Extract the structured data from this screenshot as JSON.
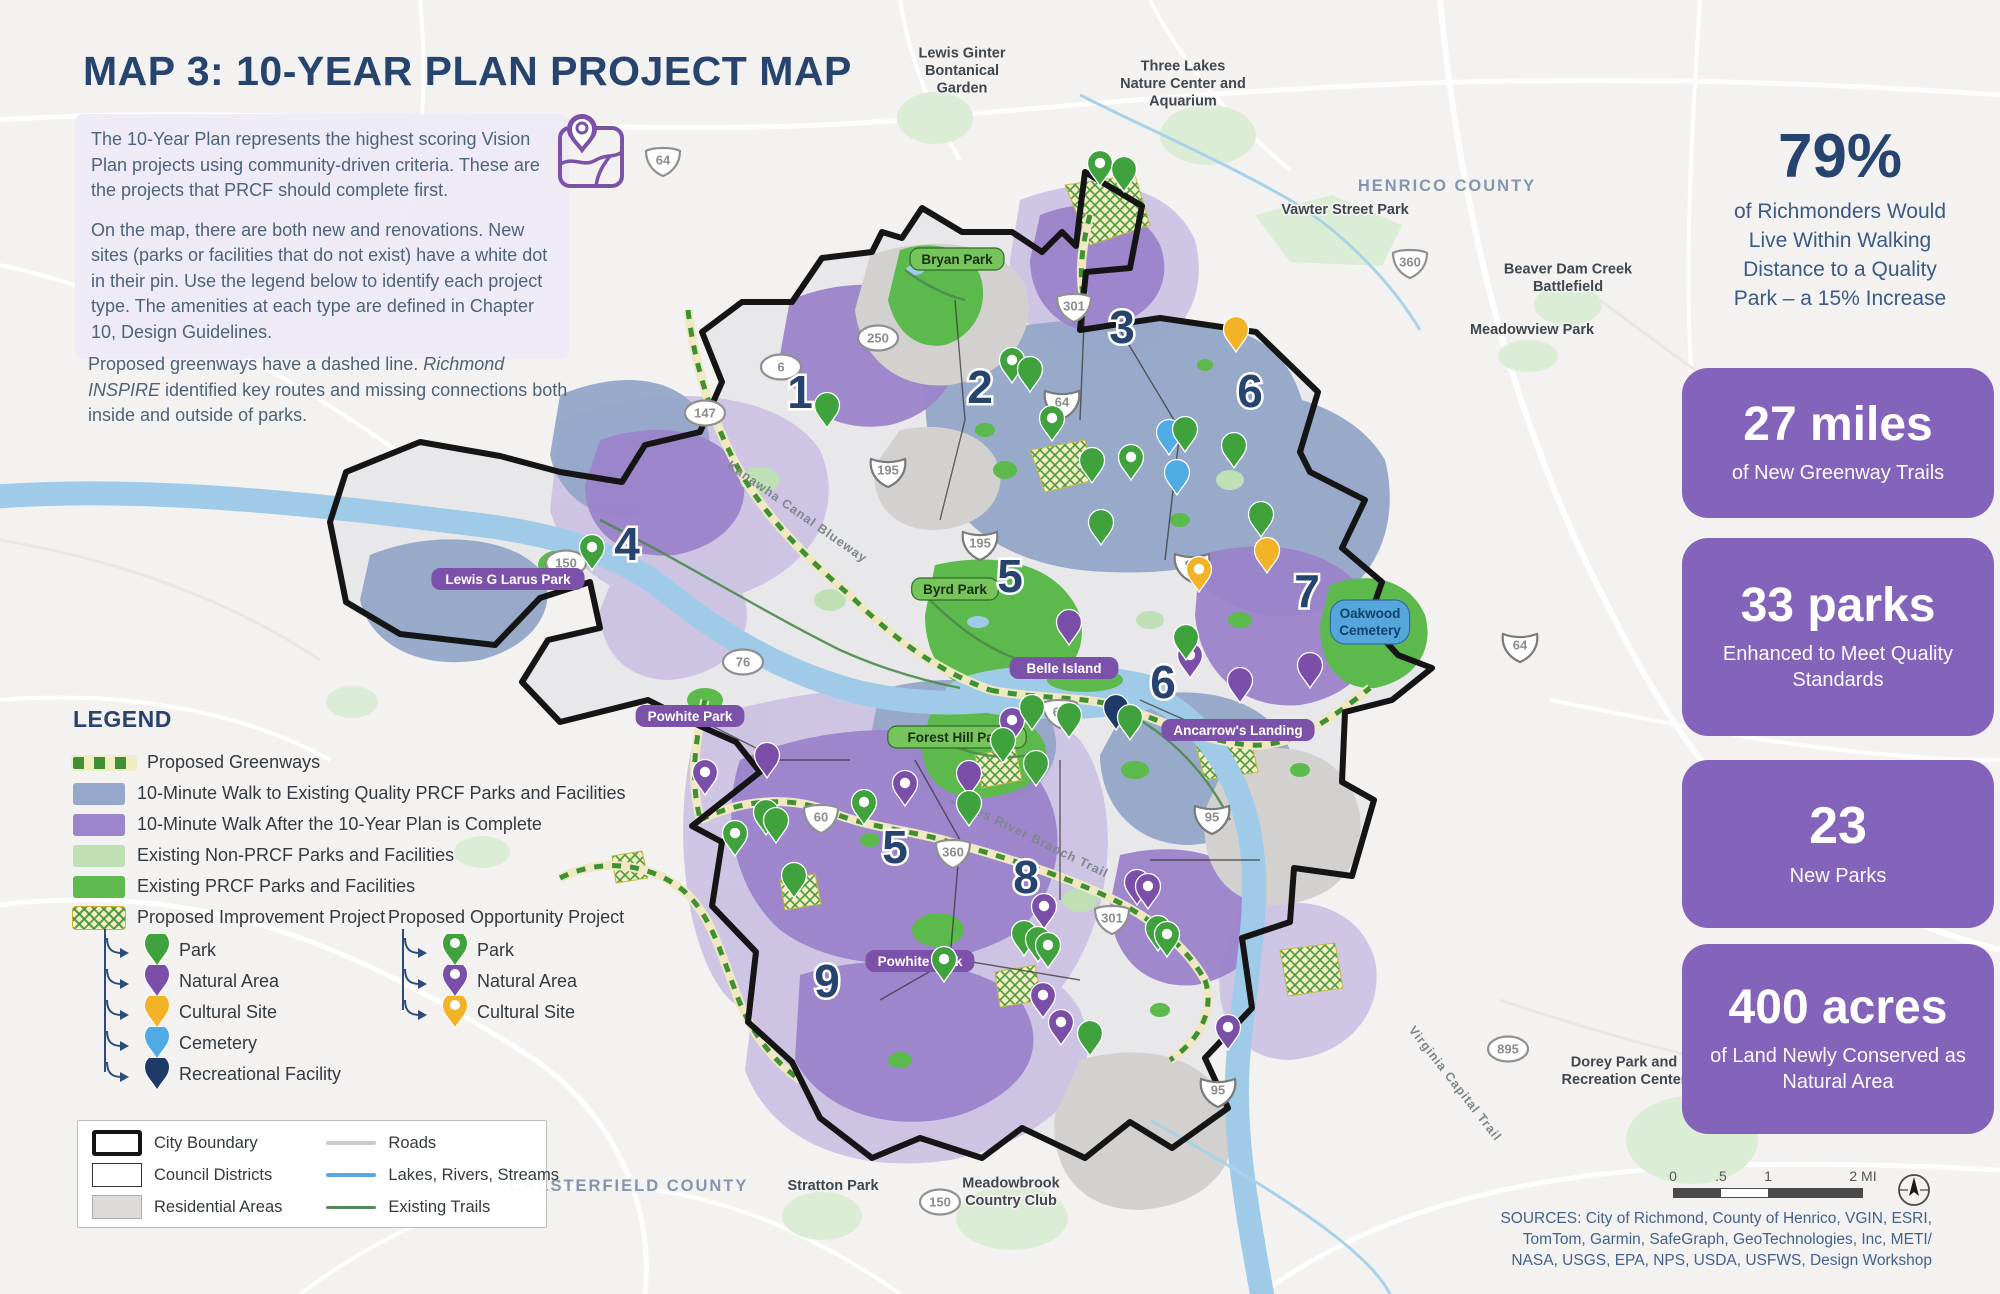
{
  "title": {
    "text": "MAP 3: 10-YEAR PLAN PROJECT MAP"
  },
  "intro": {
    "p1": " The 10-Year Plan represents the highest scoring Vision Plan projects using community-driven criteria. These are the projects that PRCF should complete first.",
    "p2": "On the map, there are both new and renovations. New sites (parks or facilities that do not exist) have a white dot in their pin. Use the legend below to identify each project type. The amenities at each type are defined in Chapter 10, Design Guidelines.",
    "p3a": "Proposed greenways have a dashed line. ",
    "p3b": "Richmond INSPIRE",
    "p3c": " identified key routes and missing connections both inside and outside of parks."
  },
  "stats": {
    "headline": {
      "value": "79%",
      "caption": "of Richmonders Would Live Within Walking Distance to a Quality Park – a 15% Increase"
    },
    "boxes": [
      {
        "value": "27 miles",
        "caption": "of New Greenway Trails"
      },
      {
        "value": "33 parks",
        "caption": "Enhanced to Meet Quality Standards"
      },
      {
        "value": "23",
        "caption": "New Parks"
      },
      {
        "value": "400 acres",
        "caption": "of Land Newly Conserved as Natural Area"
      }
    ]
  },
  "legend": {
    "heading": "LEGEND",
    "area_items": [
      {
        "swatch": "greenway-dash",
        "label": "Proposed Greenways"
      },
      {
        "swatch": "blue-gray",
        "label": "10-Minute Walk to Existing Quality PRCF Parks and Facilities"
      },
      {
        "swatch": "purple",
        "label": "10-Minute Walk After the 10-Year Plan is Complete"
      },
      {
        "swatch": "light-green",
        "label": "Existing Non-PRCF Parks and Facilities"
      },
      {
        "swatch": "green",
        "label": "Existing PRCF Parks and Facilities"
      }
    ],
    "improvement": {
      "title": "Proposed Improvement Project",
      "items": [
        {
          "pin": "green",
          "dot": false,
          "label": "Park"
        },
        {
          "pin": "purple",
          "dot": false,
          "label": "Natural Area"
        },
        {
          "pin": "yellow",
          "dot": false,
          "label": "Cultural Site"
        },
        {
          "pin": "blue",
          "dot": false,
          "label": "Cemetery"
        },
        {
          "pin": "navy",
          "dot": false,
          "label": "Recreational Facility"
        }
      ]
    },
    "opportunity": {
      "title": "Proposed Opportunity Project",
      "items": [
        {
          "pin": "green",
          "dot": true,
          "label": "Park"
        },
        {
          "pin": "purple",
          "dot": true,
          "label": "Natural Area"
        },
        {
          "pin": "yellow",
          "dot": true,
          "label": "Cultural Site"
        }
      ]
    },
    "base_items_col1": [
      {
        "swatch": "city-boundary",
        "label": "City Boundary"
      },
      {
        "swatch": "council-districts",
        "label": "Council Districts"
      },
      {
        "swatch": "residential",
        "label": "Residential Areas"
      }
    ],
    "base_items_col2": [
      {
        "swatch": "road-line",
        "label": "Roads"
      },
      {
        "swatch": "water-line",
        "label": "Lakes, Rivers, Streams"
      },
      {
        "swatch": "trail-line",
        "label": "Existing Trails"
      }
    ]
  },
  "map": {
    "county_labels": [
      {
        "text": "HENRICO COUNTY",
        "x": 1447,
        "y": 191
      },
      {
        "text": "CHESTERFIELD COUNTY",
        "x": 629,
        "y": 1191
      }
    ],
    "place_labels": [
      {
        "text": "Lewis Ginter\nBontanical\nGarden",
        "x": 962,
        "y": 75
      },
      {
        "text": "Three Lakes\nNature Center and\nAquarium",
        "x": 1183,
        "y": 88
      },
      {
        "text": "Vawter Street Park",
        "x": 1345,
        "y": 214
      },
      {
        "text": "Beaver Dam Creek\nBattlefield",
        "x": 1568,
        "y": 282
      },
      {
        "text": "Meadowview Park",
        "x": 1532,
        "y": 334
      },
      {
        "text": "Stratton Park",
        "x": 833,
        "y": 1190
      },
      {
        "text": "Meadowbrook\nCountry Club",
        "x": 1011,
        "y": 1196
      },
      {
        "text": "Dorey Park and\nRecreation Center",
        "x": 1624,
        "y": 1075
      }
    ],
    "park_pills": [
      {
        "text": "Bryan Park",
        "style": "green",
        "x": 957,
        "y": 259
      },
      {
        "text": "Byrd Park",
        "style": "green",
        "x": 955,
        "y": 589
      },
      {
        "text": "Forest Hill Park",
        "style": "green",
        "x": 957,
        "y": 737
      },
      {
        "text": "Belle Island",
        "style": "purple",
        "x": 1064,
        "y": 668
      },
      {
        "text": "Lewis G Larus Park",
        "style": "purple",
        "x": 508,
        "y": 579
      },
      {
        "text": "Powhite Park",
        "style": "purple",
        "x": 690,
        "y": 716
      },
      {
        "text": "Powhite Park",
        "style": "purple",
        "x": 920,
        "y": 961
      },
      {
        "text": "Ancarrow's Landing",
        "style": "purple",
        "x": 1238,
        "y": 730
      },
      {
        "text": "Oakwood\nCemetery",
        "style": "blue",
        "x": 1370,
        "y": 622
      }
    ],
    "trail_labels": [
      {
        "text": "Virginia Capital Trail",
        "x": 1452,
        "y": 1086,
        "rot": 52
      },
      {
        "text": "James River Branch Trail",
        "x": 1028,
        "y": 840,
        "rot": 26
      },
      {
        "text": "Kanawha Canal Blueway",
        "x": 795,
        "y": 515,
        "rot": 35
      }
    ],
    "shields": [
      {
        "num": "64",
        "type": "shield",
        "x": 663,
        "y": 160
      },
      {
        "num": "250",
        "type": "oval",
        "x": 878,
        "y": 338
      },
      {
        "num": "301",
        "type": "shield",
        "x": 1074,
        "y": 306
      },
      {
        "num": "360",
        "type": "shield",
        "x": 1410,
        "y": 262
      },
      {
        "num": "64",
        "type": "interstate",
        "x": 1062,
        "y": 402
      },
      {
        "num": "6",
        "type": "oval",
        "x": 781,
        "y": 367
      },
      {
        "num": "147",
        "type": "oval",
        "x": 705,
        "y": 413
      },
      {
        "num": "195",
        "type": "interstate",
        "x": 888,
        "y": 470
      },
      {
        "num": "195",
        "type": "interstate",
        "x": 980,
        "y": 543
      },
      {
        "num": "150",
        "type": "oval",
        "x": 566,
        "y": 563
      },
      {
        "num": "76",
        "type": "oval",
        "x": 743,
        "y": 662
      },
      {
        "num": "95",
        "type": "interstate",
        "x": 1192,
        "y": 565
      },
      {
        "num": "64",
        "type": "interstate",
        "x": 1520,
        "y": 645
      },
      {
        "num": "60",
        "type": "shield",
        "x": 1060,
        "y": 712
      },
      {
        "num": "60",
        "type": "shield",
        "x": 821,
        "y": 817
      },
      {
        "num": "360",
        "type": "shield",
        "x": 953,
        "y": 852
      },
      {
        "num": "95",
        "type": "interstate",
        "x": 1212,
        "y": 817
      },
      {
        "num": "301",
        "type": "shield",
        "x": 1112,
        "y": 918
      },
      {
        "num": "95",
        "type": "interstate",
        "x": 1218,
        "y": 1090
      },
      {
        "num": "150",
        "type": "oval",
        "x": 940,
        "y": 1202
      },
      {
        "num": "895",
        "type": "oval",
        "x": 1508,
        "y": 1049
      }
    ],
    "districts": [
      {
        "n": "1",
        "x": 800,
        "y": 408
      },
      {
        "n": "2",
        "x": 980,
        "y": 403
      },
      {
        "n": "3",
        "x": 1122,
        "y": 343
      },
      {
        "n": "4",
        "x": 627,
        "y": 560
      },
      {
        "n": "5",
        "x": 1010,
        "y": 592
      },
      {
        "n": "5",
        "x": 895,
        "y": 863
      },
      {
        "n": "6",
        "x": 1250,
        "y": 407
      },
      {
        "n": "6",
        "x": 1163,
        "y": 698
      },
      {
        "n": "7",
        "x": 1307,
        "y": 607
      },
      {
        "n": "8",
        "x": 1026,
        "y": 893
      },
      {
        "n": "9",
        "x": 827,
        "y": 997
      }
    ],
    "pins": [
      {
        "c": "green",
        "dot": true,
        "x": 1100,
        "y": 186
      },
      {
        "c": "green",
        "dot": false,
        "x": 1124,
        "y": 192
      },
      {
        "c": "yellow",
        "dot": false,
        "x": 1236,
        "y": 352
      },
      {
        "c": "green",
        "dot": true,
        "x": 1012,
        "y": 383
      },
      {
        "c": "green",
        "dot": false,
        "x": 1030,
        "y": 392
      },
      {
        "c": "green",
        "dot": true,
        "x": 1052,
        "y": 441
      },
      {
        "c": "green",
        "dot": false,
        "x": 1092,
        "y": 483
      },
      {
        "c": "green",
        "dot": true,
        "x": 1131,
        "y": 480
      },
      {
        "c": "blue",
        "dot": false,
        "x": 1169,
        "y": 455
      },
      {
        "c": "blue",
        "dot": false,
        "x": 1177,
        "y": 495
      },
      {
        "c": "green",
        "dot": false,
        "x": 1185,
        "y": 452
      },
      {
        "c": "green",
        "dot": false,
        "x": 1234,
        "y": 468
      },
      {
        "c": "green",
        "dot": false,
        "x": 827,
        "y": 428
      },
      {
        "c": "green",
        "dot": true,
        "x": 592,
        "y": 570
      },
      {
        "c": "green",
        "dot": false,
        "x": 1101,
        "y": 545
      },
      {
        "c": "green",
        "dot": false,
        "x": 1261,
        "y": 537
      },
      {
        "c": "yellow",
        "dot": false,
        "x": 1267,
        "y": 573
      },
      {
        "c": "yellow",
        "dot": true,
        "x": 1199,
        "y": 592
      },
      {
        "c": "purple",
        "dot": false,
        "x": 1310,
        "y": 688
      },
      {
        "c": "purple",
        "dot": false,
        "x": 1240,
        "y": 703
      },
      {
        "c": "purple",
        "dot": true,
        "x": 1190,
        "y": 678
      },
      {
        "c": "green",
        "dot": false,
        "x": 1186,
        "y": 660
      },
      {
        "c": "purple",
        "dot": false,
        "x": 1069,
        "y": 645
      },
      {
        "c": "purple",
        "dot": true,
        "x": 1012,
        "y": 743
      },
      {
        "c": "green",
        "dot": false,
        "x": 1032,
        "y": 730
      },
      {
        "c": "green",
        "dot": false,
        "x": 1003,
        "y": 763
      },
      {
        "c": "green",
        "dot": false,
        "x": 1069,
        "y": 738
      },
      {
        "c": "green",
        "dot": false,
        "x": 1036,
        "y": 786
      },
      {
        "c": "navy",
        "dot": false,
        "x": 1116,
        "y": 730
      },
      {
        "c": "green",
        "dot": false,
        "x": 1130,
        "y": 740
      },
      {
        "c": "purple",
        "dot": false,
        "x": 969,
        "y": 796
      },
      {
        "c": "green",
        "dot": false,
        "x": 969,
        "y": 826
      },
      {
        "c": "purple",
        "dot": true,
        "x": 705,
        "y": 795
      },
      {
        "c": "purple",
        "dot": false,
        "x": 767,
        "y": 778
      },
      {
        "c": "green",
        "dot": true,
        "x": 864,
        "y": 825
      },
      {
        "c": "purple",
        "dot": true,
        "x": 905,
        "y": 806
      },
      {
        "c": "green",
        "dot": false,
        "x": 766,
        "y": 835
      },
      {
        "c": "green",
        "dot": false,
        "x": 776,
        "y": 843
      },
      {
        "c": "green",
        "dot": true,
        "x": 735,
        "y": 856
      },
      {
        "c": "green",
        "dot": false,
        "x": 794,
        "y": 898
      },
      {
        "c": "green",
        "dot": true,
        "x": 944,
        "y": 982
      },
      {
        "c": "purple",
        "dot": true,
        "x": 1044,
        "y": 929
      },
      {
        "c": "green",
        "dot": false,
        "x": 1024,
        "y": 956
      },
      {
        "c": "green",
        "dot": false,
        "x": 1038,
        "y": 962
      },
      {
        "c": "green",
        "dot": true,
        "x": 1048,
        "y": 968
      },
      {
        "c": "purple",
        "dot": false,
        "x": 1137,
        "y": 905
      },
      {
        "c": "purple",
        "dot": true,
        "x": 1148,
        "y": 909
      },
      {
        "c": "green",
        "dot": false,
        "x": 1158,
        "y": 951
      },
      {
        "c": "green",
        "dot": true,
        "x": 1167,
        "y": 957
      },
      {
        "c": "purple",
        "dot": true,
        "x": 1043,
        "y": 1018
      },
      {
        "c": "purple",
        "dot": true,
        "x": 1061,
        "y": 1045
      },
      {
        "c": "green",
        "dot": false,
        "x": 1090,
        "y": 1056
      },
      {
        "c": "purple",
        "dot": true,
        "x": 1228,
        "y": 1050
      }
    ]
  },
  "scalebar": {
    "labels": [
      "0",
      ".5",
      "1",
      "2 MI"
    ]
  },
  "sources": {
    "line1": "SOURCES: City of Richmond, County of Henrico, VGIN, ESRI,",
    "line2": "TomTom, Garmin, SafeGraph, GeoTechnologies, Inc, METI/",
    "line3": "NASA, USGS, EPA, NPS, USDA, USFWS, Design Workshop"
  },
  "colors": {
    "navy_title": "#27446E",
    "body_text": "#4E6377",
    "stat_purple": "#8464BB",
    "walk_existing": "#96A8C9",
    "walk_after": "#9C85CB",
    "non_prcf_green": "#BEE0B4",
    "prcf_green": "#5FBA4F",
    "water": "#9FCBE8",
    "pin": {
      "green": "#3FA23C",
      "purple": "#7B4FA9",
      "yellow": "#F2B327",
      "blue": "#4FACE4",
      "navy": "#1F3A68"
    }
  }
}
